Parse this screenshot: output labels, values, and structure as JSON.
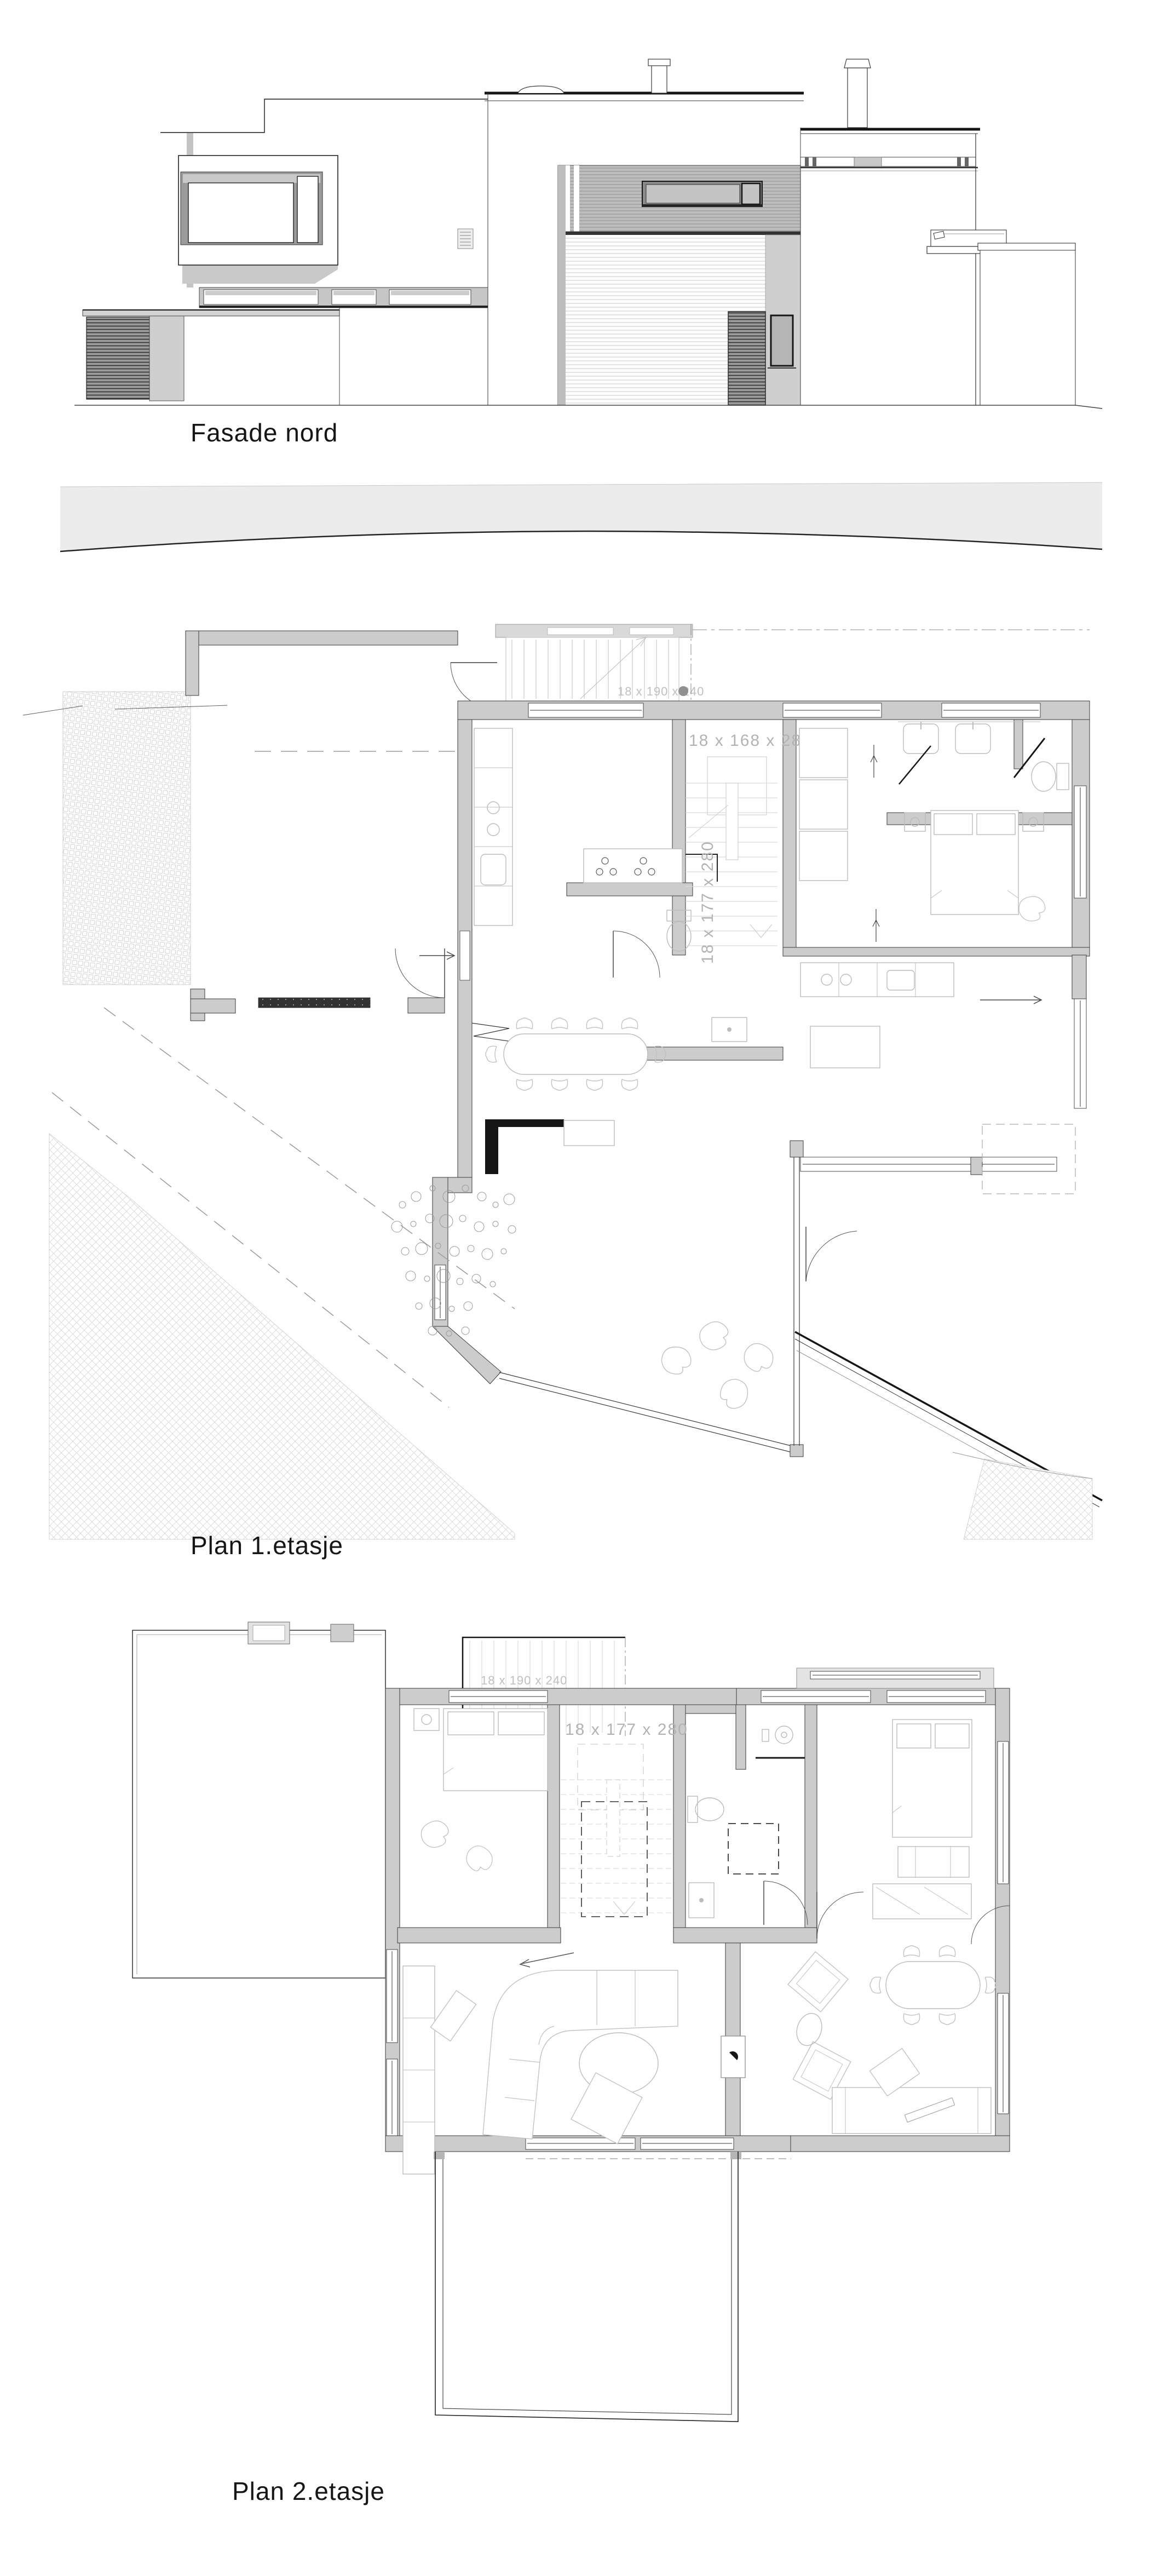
{
  "document": {
    "type": "architectural drawing sheet",
    "background": "#ffffff"
  },
  "sections": {
    "facade": {
      "label": "Fasade nord"
    },
    "plan1": {
      "label": "Plan 1.etasje",
      "stair_dims": {
        "main": "18 x 168 x 280",
        "lower": "18 x 177 x 280",
        "exterior": "18 x 190 x 240"
      }
    },
    "plan2": {
      "label": "Plan 2.etasje",
      "stair_dims": {
        "main": "18 x 177 x 280",
        "exterior": "18 x 190 x 240"
      }
    }
  },
  "colors": {
    "wall_fill": "#cccccc",
    "line": "#3a3a3a",
    "furniture_line": "#bcbcbc",
    "dim_text": "#b3b3b3",
    "road_band": "#ececec",
    "dark": "#161616"
  }
}
